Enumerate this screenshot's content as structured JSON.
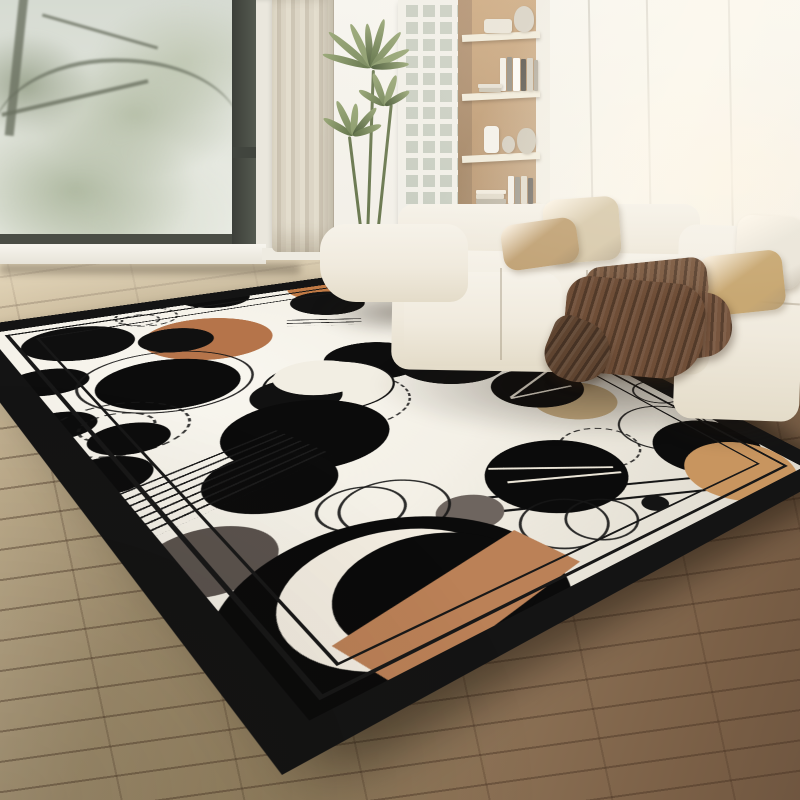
{
  "meta": {
    "title": "Living room with black-and-cream abstract circle area rug",
    "width": 800,
    "height": 800
  },
  "palette": {
    "wall": "#f6f4ee",
    "floor_near": "#6f5640",
    "floor_far": "#cdbc9c",
    "sofa_fabric": "#f2ede2",
    "rug_field": "#f2eee3",
    "rug_border": "#141414",
    "accent_terracotta": "#b5744a",
    "accent_orange": "#c8955f",
    "accent_khaki": "#c3a97e",
    "blanket_brown": "#6f4e37",
    "plant_green": "#5d6f45"
  },
  "window": {
    "frame": "#4a4d45",
    "casing": "#eae7dd",
    "sill": "#f7f5ee",
    "glass_top": "#d6dbd2",
    "glass_bottom": "#eef0e9",
    "view": "foggy trees"
  },
  "curtain": {
    "pleat_light": "#e3ddcd",
    "pleat_dark": "#cec6b5"
  },
  "grid_panel": {
    "frame": "#f1efe8",
    "cell": "#c9cec2"
  },
  "plant": {
    "stem": "#6d7b53",
    "leaf_colors": [
      "#5d6f45",
      "#75865a",
      "#8b9b6c",
      "#4c5c3a"
    ],
    "stems": [
      {
        "x": 369,
        "y": 70,
        "h": 165,
        "a": 2
      },
      {
        "x": 354,
        "y": 136,
        "h": 100,
        "a": -7
      },
      {
        "x": 383,
        "y": 104,
        "h": 130,
        "a": 6
      }
    ],
    "clusters": [
      {
        "x": 371,
        "y": 64,
        "leaves": [
          [
            -165,
            50
          ],
          [
            -140,
            55
          ],
          [
            -115,
            48
          ],
          [
            -95,
            44
          ],
          [
            -75,
            50
          ],
          [
            -50,
            46
          ],
          [
            -25,
            42
          ],
          [
            -5,
            38
          ]
        ]
      },
      {
        "x": 353,
        "y": 132,
        "leaves": [
          [
            -150,
            34
          ],
          [
            -115,
            38
          ],
          [
            -85,
            32
          ],
          [
            -50,
            36
          ],
          [
            -20,
            30
          ]
        ]
      },
      {
        "x": 385,
        "y": 102,
        "leaves": [
          [
            -150,
            30
          ],
          [
            -110,
            34
          ],
          [
            -70,
            32
          ],
          [
            -30,
            28
          ]
        ]
      }
    ]
  },
  "shelf": {
    "side": "#b19070",
    "back": "#cba77e",
    "pillar": "#efece3",
    "board": "#f0ead9",
    "boards_y": [
      33,
      92,
      154,
      205
    ],
    "items": [
      {
        "name": "box-vase",
        "x": 26,
        "y": 19,
        "w": 28,
        "h": 14,
        "c": "#e8e3d6",
        "r": "3px"
      },
      {
        "name": "sphere-vase",
        "x": 56,
        "y": 6,
        "w": 20,
        "h": 26,
        "c": "#d6d0c3",
        "r": "50% 50% 42% 42%"
      },
      {
        "name": "book",
        "x": 42,
        "y": 58,
        "w": 6,
        "h": 33,
        "c": "#f1eee6"
      },
      {
        "name": "book",
        "x": 49,
        "y": 57,
        "w": 5,
        "h": 34,
        "c": "#8d887d"
      },
      {
        "name": "book",
        "x": 55,
        "y": 58,
        "w": 7,
        "h": 33,
        "c": "#fbfaf6"
      },
      {
        "name": "book",
        "x": 63,
        "y": 59,
        "w": 5,
        "h": 32,
        "c": "#4a463f"
      },
      {
        "name": "book",
        "x": 69,
        "y": 58,
        "w": 6,
        "h": 33,
        "c": "#cfc9bb"
      },
      {
        "name": "book",
        "x": 76,
        "y": 60,
        "w": 4,
        "h": 31,
        "c": "#a9a294"
      },
      {
        "name": "book-flat",
        "x": 20,
        "y": 84,
        "w": 24,
        "h": 4,
        "c": "#e5dfd2"
      },
      {
        "name": "book-flat",
        "x": 21,
        "y": 88,
        "w": 22,
        "h": 4,
        "c": "#c9c2b2"
      },
      {
        "name": "cylinder-vase",
        "x": 26,
        "y": 126,
        "w": 15,
        "h": 27,
        "c": "#f3f0e9",
        "r": "4px"
      },
      {
        "name": "ball-vase",
        "x": 44,
        "y": 136,
        "w": 13,
        "h": 17,
        "c": "#cfc8ba",
        "r": "50%"
      },
      {
        "name": "pear-vase",
        "x": 59,
        "y": 128,
        "w": 19,
        "h": 26,
        "c": "#c9c2b2",
        "r": "46% 46% 50% 50%"
      },
      {
        "name": "book-flat",
        "x": 18,
        "y": 190,
        "w": 30,
        "h": 4,
        "c": "#efe9dc"
      },
      {
        "name": "book-flat",
        "x": 18,
        "y": 194,
        "w": 28,
        "h": 5,
        "c": "#ddd6c6"
      },
      {
        "name": "book-flat",
        "x": 18,
        "y": 199,
        "w": 30,
        "h": 5,
        "c": "#b5ae9e"
      },
      {
        "name": "book",
        "x": 50,
        "y": 176,
        "w": 6,
        "h": 28,
        "c": "#f0ede5"
      },
      {
        "name": "book",
        "x": 57,
        "y": 177,
        "w": 5,
        "h": 27,
        "c": "#8d887d"
      },
      {
        "name": "book",
        "x": 63,
        "y": 176,
        "w": 6,
        "h": 28,
        "c": "#dcd5c6"
      },
      {
        "name": "book",
        "x": 70,
        "y": 178,
        "w": 5,
        "h": 26,
        "c": "#55504a"
      }
    ]
  },
  "wall_seams_x": [
    590,
    648,
    730
  ],
  "sofa": {
    "fabric": "#f2ede2",
    "pillows": [
      {
        "name": "pillow-cream-left",
        "x": 544,
        "y": 198,
        "w": 76,
        "h": 64,
        "a": -4,
        "c": "#d9cbae"
      },
      {
        "name": "pillow-tan-left",
        "x": 502,
        "y": 221,
        "w": 76,
        "h": 46,
        "a": -8,
        "c": "#c2a478"
      },
      {
        "name": "pillow-white-right",
        "x": 736,
        "y": 216,
        "w": 66,
        "h": 72,
        "a": 3,
        "c": "#ebe6da"
      },
      {
        "name": "pillow-tan-right",
        "x": 700,
        "y": 253,
        "w": 84,
        "h": 60,
        "a": -6,
        "c": "#c8a873"
      }
    ]
  },
  "blanket": {
    "parts": [
      {
        "name": "blanket-top-fold",
        "x": 586,
        "y": 262,
        "w": 122,
        "h": 46,
        "a": -6,
        "c": "#7d5c43",
        "r": "16px"
      },
      {
        "name": "blanket-right-spill",
        "x": 636,
        "y": 296,
        "w": 96,
        "h": 64,
        "a": -9,
        "c": "#78563f",
        "r": "20px 26px 30px 22px"
      },
      {
        "name": "blanket-main-drape",
        "x": 564,
        "y": 280,
        "w": 140,
        "h": 96,
        "a": 5,
        "c": "#6f4e37",
        "r": "24px 30px 42px 30px"
      },
      {
        "name": "blanket-tip",
        "x": 546,
        "y": 320,
        "w": 64,
        "h": 62,
        "a": 22,
        "c": "#5f4430",
        "r": "30% 60% 60% 50%"
      }
    ]
  },
  "rug": {
    "size": [
      480,
      660
    ],
    "corners": {
      "w": [
        -55,
        330
      ],
      "n": [
        435,
        262
      ],
      "s": [
        282,
        775
      ],
      "e": [
        840,
        470
      ]
    },
    "border_width": 24,
    "border_color": "#141414",
    "field": "#f2eee3",
    "inner_lines": [
      {
        "inset": 34,
        "w": 3
      },
      {
        "inset": 52,
        "w": 2.5
      }
    ],
    "elements": [
      {
        "t": "d",
        "name": "dashed-ring",
        "s": [
          147,
          317
        ],
        "r": 26
      },
      {
        "t": "d",
        "name": "dashed-ring",
        "s": [
          140,
          320
        ],
        "r": 16
      },
      {
        "t": "c",
        "name": "terracotta-circle",
        "s": [
          210,
          338
        ],
        "r": 53,
        "f": "#b5744a"
      },
      {
        "t": "c",
        "name": "black-circle",
        "s": [
          177,
          340
        ],
        "r": 30,
        "f": "#101010"
      },
      {
        "t": "c",
        "name": "black-circle",
        "s": [
          214,
          297
        ],
        "r": 33,
        "f": "#0e0e0e"
      },
      {
        "t": "c",
        "name": "orange-crescent-back",
        "s": [
          324,
          289
        ],
        "r": 37,
        "f": "#c07a45"
      },
      {
        "t": "c",
        "name": "black-circle-scratched",
        "s": [
          328,
          303
        ],
        "r": 37,
        "f": "#121212",
        "tex": 1
      },
      {
        "t": "c",
        "name": "black-circle-scratched",
        "s": [
          80,
          343
        ],
        "r": 41,
        "f": "#0f0f0f",
        "tex": 1
      },
      {
        "t": "ln",
        "name": "line-pair",
        "s": [
          325,
          322
        ],
        "len": 70,
        "n": 2,
        "gap": 9,
        "a": 25,
        "col": "#1a1a1a"
      },
      {
        "t": "c",
        "name": "black-circle",
        "s": [
          48,
          382
        ],
        "r": 27,
        "f": "#0d0d0d"
      },
      {
        "t": "c",
        "name": "black-circle",
        "s": [
          58,
          426
        ],
        "r": 24,
        "f": "#0d0d0d"
      },
      {
        "t": "r",
        "name": "thin-ring",
        "s": [
          168,
          380
        ],
        "r": 64
      },
      {
        "t": "c",
        "name": "black-circle",
        "s": [
          170,
          383
        ],
        "r": 52,
        "f": "#0c0c0c"
      },
      {
        "t": "d",
        "name": "dashed-ring",
        "s": [
          120,
          428
        ],
        "r": 46
      },
      {
        "t": "d",
        "name": "dashed-ring",
        "s": [
          118,
          427
        ],
        "r": 25
      },
      {
        "t": "c",
        "name": "black-circle",
        "s": [
          130,
          438
        ],
        "r": 26,
        "f": "#0d0d0d"
      },
      {
        "t": "c",
        "name": "black-circle",
        "s": [
          106,
          476
        ],
        "r": 28,
        "f": "#0d0d0d"
      },
      {
        "t": "c",
        "name": "black-circle",
        "s": [
          375,
          360
        ],
        "r": 45,
        "f": "#0d0d0d"
      },
      {
        "t": "d",
        "name": "dashed-ring",
        "s": [
          340,
          400
        ],
        "r": 58
      },
      {
        "t": "c",
        "name": "white-circle-outlined",
        "s": [
          330,
          385
        ],
        "r": 54,
        "f": "#f2eee3",
        "stroke": 1
      },
      {
        "t": "c",
        "name": "black-crescent",
        "s": [
          297,
          396
        ],
        "r": 36,
        "f": "#111111"
      },
      {
        "t": "c",
        "name": "field-cover-circle",
        "s": [
          320,
          377
        ],
        "r": 38,
        "f": "#f2eee3"
      },
      {
        "t": "c",
        "name": "big-black-circle",
        "s": [
          308,
          433
        ],
        "r": 61,
        "f": "#0b0b0b"
      },
      {
        "t": "c",
        "name": "black-circle",
        "s": [
          272,
          481
        ],
        "r": 44,
        "f": "#0c0c0c"
      },
      {
        "t": "ln",
        "name": "hatch-lines",
        "s": [
          200,
          487
        ],
        "len": 170,
        "n": 7,
        "gap": 9,
        "a": -15,
        "col": "#1c1c1c"
      },
      {
        "t": "ln",
        "name": "line-pair",
        "s": [
          320,
          562
        ],
        "len": 44,
        "n": 2,
        "gap": 8,
        "a": -15,
        "col": "#1c1c1c"
      },
      {
        "t": "c",
        "name": "gray-circle",
        "s": [
          210,
          560
        ],
        "r": 38,
        "f": "#5b534e"
      },
      {
        "t": "c",
        "name": "black-circle-scratched",
        "s": [
          452,
          362
        ],
        "r": 52,
        "f": "#101010",
        "tex": 1
      },
      {
        "t": "c",
        "name": "khaki-circle",
        "s": [
          522,
          348
        ],
        "r": 24,
        "f": "#c2a878"
      },
      {
        "t": "c",
        "name": "khaki-circle",
        "s": [
          575,
          400
        ],
        "r": 40,
        "f": "#c3a97e"
      },
      {
        "t": "c",
        "name": "black-circle",
        "s": [
          538,
          387
        ],
        "r": 44,
        "f": "#0d0d0d"
      },
      {
        "t": "ln",
        "name": "white-scribble-line",
        "s": [
          532,
          382
        ],
        "len": 80,
        "n": 1,
        "gap": 3,
        "a": -25,
        "col": "#e8e2d4"
      },
      {
        "t": "ln",
        "name": "white-scribble-line",
        "s": [
          542,
          392
        ],
        "len": 65,
        "n": 1,
        "gap": 3,
        "a": 8,
        "col": "#e8e2d4"
      },
      {
        "t": "d",
        "name": "dashed-ring",
        "s": [
          600,
          447
        ],
        "r": 36
      },
      {
        "t": "ln",
        "name": "long-stem-line",
        "s": [
          640,
          483
        ],
        "len": 250,
        "n": 1,
        "gap": 3,
        "a": 27,
        "col": "#151515"
      },
      {
        "t": "ln",
        "name": "long-stem-line",
        "s": [
          657,
          495
        ],
        "len": 255,
        "n": 1,
        "gap": 3,
        "a": 27,
        "col": "#151515"
      },
      {
        "t": "c",
        "name": "black-circle",
        "s": [
          558,
          474
        ],
        "r": 57,
        "f": "#0b0b0b"
      },
      {
        "t": "ln",
        "name": "white-scribble-line",
        "s": [
          552,
          468
        ],
        "len": 100,
        "n": 1,
        "gap": 3,
        "a": 35,
        "col": "#ece6d8"
      },
      {
        "t": "ln",
        "name": "white-scribble-line",
        "s": [
          566,
          477
        ],
        "len": 92,
        "n": 1,
        "gap": 3,
        "a": 27,
        "col": "#ece6d8"
      },
      {
        "t": "r",
        "name": "thin-ring",
        "s": [
          565,
          523
        ],
        "r": 33
      },
      {
        "t": "r",
        "name": "thin-ring",
        "s": [
          602,
          519
        ],
        "r": 28
      },
      {
        "t": "r",
        "name": "thin-ring",
        "s": [
          658,
          392
        ],
        "r": 26
      },
      {
        "t": "r",
        "name": "thin-ring",
        "s": [
          665,
          427
        ],
        "r": 44
      },
      {
        "t": "c",
        "name": "black-circle",
        "s": [
          708,
          446
        ],
        "r": 50,
        "f": "#0c0c0c"
      },
      {
        "t": "c",
        "name": "orange-circle",
        "s": [
          741,
          470
        ],
        "r": 50,
        "f": "#c8955f"
      },
      {
        "t": "c",
        "name": "black-dot",
        "s": [
          655,
          503
        ],
        "r": 11,
        "f": "#141414"
      },
      {
        "t": "c",
        "name": "gray-circle",
        "s": [
          470,
          512
        ],
        "r": 24,
        "f": "#6e655f"
      },
      {
        "t": "r",
        "name": "thin-ring",
        "s": [
          362,
          508
        ],
        "r": 30
      },
      {
        "t": "r",
        "name": "thin-ring",
        "s": [
          396,
          507
        ],
        "r": 38
      },
      {
        "t": "c",
        "name": "big-black-circle",
        "s": [
          405,
          610
        ],
        "r": 103,
        "f": "#0b0b0b"
      },
      {
        "t": "c",
        "name": "white-crescent",
        "s": [
          402,
          592
        ],
        "r": 70,
        "f": "#f2ece0"
      },
      {
        "t": "c",
        "name": "black-cover-circle",
        "s": [
          440,
          588
        ],
        "r": 62,
        "f": "#0b0b0b"
      },
      {
        "t": "rect",
        "name": "tan-band",
        "s": [
          468,
          600
        ],
        "w": 150,
        "h": 60,
        "a": -12,
        "f": "#bb8157"
      }
    ]
  }
}
